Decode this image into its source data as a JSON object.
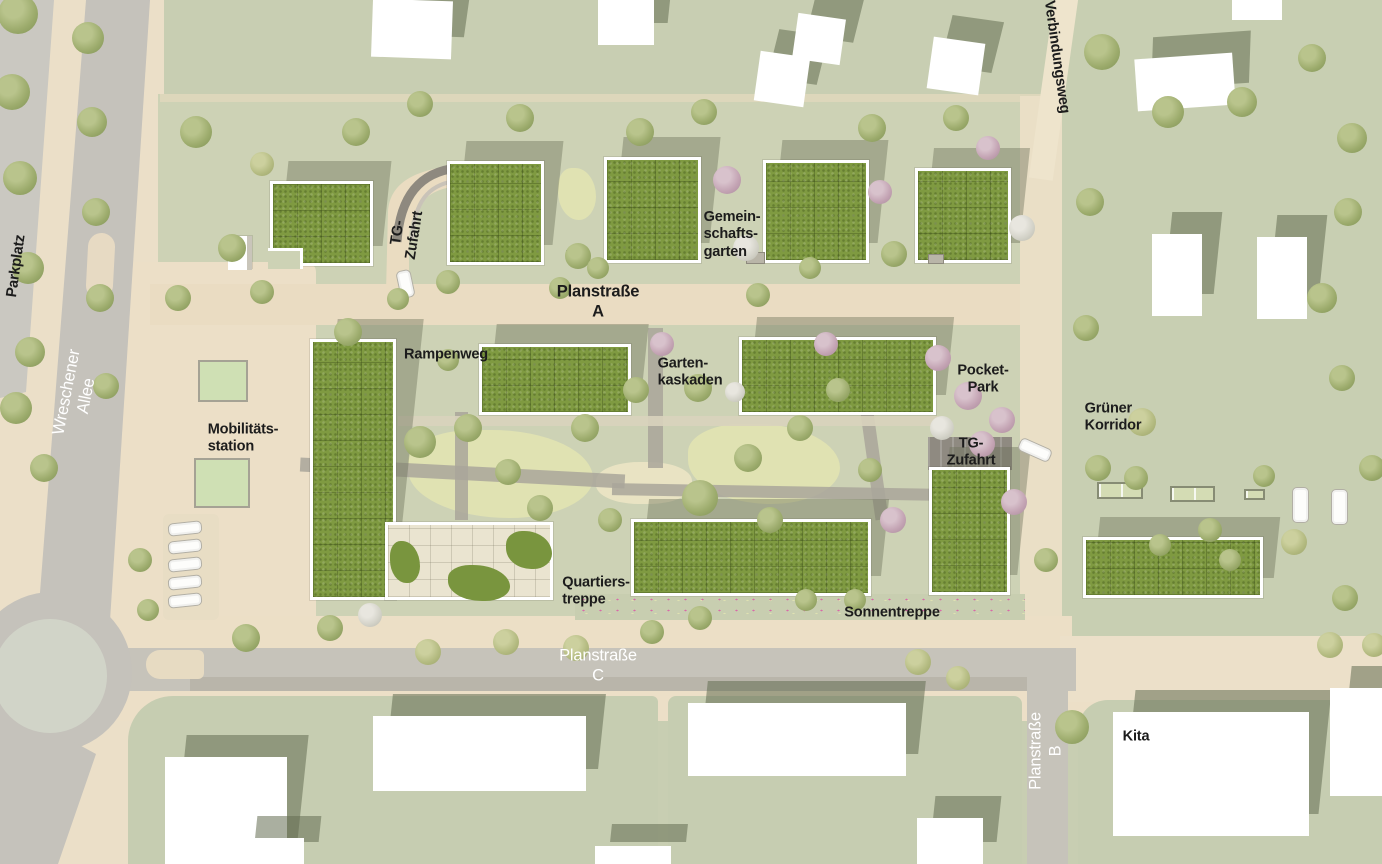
{
  "meta": {
    "title": "Quartier Lageplan (site plan)",
    "width": 1382,
    "height": 864
  },
  "palette": {
    "ground_green": "#cdd2b5",
    "road_gray": "#c6c3ba",
    "road_beige": "#eadcc2",
    "roof_green": "#7f9a41",
    "building_white": "#ffffff",
    "shadow": "#6c7058",
    "label_black": "#1c1c1c",
    "label_white": "#ffffff"
  },
  "labels": [
    {
      "id": "parkplatz",
      "text": "Parkplatz",
      "x": 16,
      "y": 266,
      "rot": -82,
      "color": "#1c1c1c",
      "size": 15,
      "weight": 700,
      "align": "center"
    },
    {
      "id": "wreschener-allee",
      "text": "Wreschener Allee",
      "x": 76,
      "y": 394,
      "rot": -79,
      "color": "#ffffff",
      "size": 17,
      "weight": 400,
      "align": "center"
    },
    {
      "id": "tg-zufahrt-nord",
      "text": "TG-Zufahrt",
      "x": 406,
      "y": 234,
      "rot": -81,
      "color": "#1c1c1c",
      "size": 15,
      "weight": 700,
      "align": "center"
    },
    {
      "id": "verbindungsweg",
      "text": "Verbindungsweg",
      "x": 1057,
      "y": 57,
      "rot": 82,
      "color": "#1c1c1c",
      "size": 15,
      "weight": 700,
      "align": "center"
    },
    {
      "id": "gemeinschaftsgarten",
      "text": "Gemein-\nschafts-\ngarten",
      "x": 732,
      "y": 234,
      "rot": 0,
      "color": "#1c1c1c",
      "size": 15,
      "weight": 700,
      "align": "left"
    },
    {
      "id": "planstrasse-a",
      "text": "Planstraße A",
      "x": 598,
      "y": 301,
      "rot": 0,
      "color": "#1c1c1c",
      "size": 17,
      "weight": 700,
      "align": "center"
    },
    {
      "id": "rampenweg",
      "text": "Rampenweg",
      "x": 446,
      "y": 354,
      "rot": 0,
      "color": "#1c1c1c",
      "size": 15,
      "weight": 700,
      "align": "center"
    },
    {
      "id": "gartenkaskaden",
      "text": "Garten-\nkaskaden",
      "x": 690,
      "y": 372,
      "rot": 0,
      "color": "#1c1c1c",
      "size": 15,
      "weight": 700,
      "align": "left"
    },
    {
      "id": "pocket-park",
      "text": "Pocket-Park",
      "x": 983,
      "y": 379,
      "rot": 0,
      "color": "#1c1c1c",
      "size": 15,
      "weight": 700,
      "align": "center"
    },
    {
      "id": "gruener-korridor",
      "text": "Grüner\nKorridor",
      "x": 1113,
      "y": 417,
      "rot": 0,
      "color": "#1c1c1c",
      "size": 15,
      "weight": 700,
      "align": "left"
    },
    {
      "id": "mobilitaetsstation",
      "text": "Mobilitäts-\nstation",
      "x": 243,
      "y": 438,
      "rot": 0,
      "color": "#1c1c1c",
      "size": 15,
      "weight": 700,
      "align": "left"
    },
    {
      "id": "tg-zufahrt-mitte",
      "text": "TG-Zufahrt",
      "x": 971,
      "y": 452,
      "rot": 0,
      "color": "#1c1c1c",
      "size": 15,
      "weight": 700,
      "align": "center"
    },
    {
      "id": "quartierstreppe",
      "text": "Quartiers-\ntreppe",
      "x": 596,
      "y": 591,
      "rot": 0,
      "color": "#1c1c1c",
      "size": 15,
      "weight": 700,
      "align": "left"
    },
    {
      "id": "sonnentreppe",
      "text": "Sonnentreppe",
      "x": 892,
      "y": 612,
      "rot": 0,
      "color": "#1c1c1c",
      "size": 15,
      "weight": 700,
      "align": "center"
    },
    {
      "id": "planstrasse-c",
      "text": "Planstraße C",
      "x": 598,
      "y": 665,
      "rot": 0,
      "color": "#ffffff",
      "size": 17,
      "weight": 400,
      "align": "center"
    },
    {
      "id": "planstrasse-b",
      "text": "Planstraße B",
      "x": 1045,
      "y": 751,
      "rot": -90,
      "color": "#ffffff",
      "size": 17,
      "weight": 400,
      "align": "center"
    },
    {
      "id": "kita",
      "text": "Kita",
      "x": 1136,
      "y": 736,
      "rot": 0,
      "color": "#1c1c1c",
      "size": 15,
      "weight": 700,
      "align": "center"
    }
  ],
  "site_buildings": [
    {
      "id": "hof-nord-1",
      "x": 270,
      "y": 181,
      "w": 103,
      "h": 85
    },
    {
      "id": "hof-nord-2",
      "x": 447,
      "y": 161,
      "w": 97,
      "h": 104
    },
    {
      "id": "hof-nord-3",
      "x": 604,
      "y": 157,
      "w": 97,
      "h": 106
    },
    {
      "id": "hof-nord-4",
      "x": 763,
      "y": 160,
      "w": 106,
      "h": 103
    },
    {
      "id": "hof-nord-5",
      "x": 915,
      "y": 168,
      "w": 96,
      "h": 95
    },
    {
      "id": "block-west",
      "x": 310,
      "y": 339,
      "w": 86,
      "h": 261
    },
    {
      "id": "block-nord-mitte",
      "x": 479,
      "y": 344,
      "w": 152,
      "h": 71
    },
    {
      "id": "block-nord-ost",
      "x": 739,
      "y": 337,
      "w": 197,
      "h": 78
    },
    {
      "id": "block-ost",
      "x": 929,
      "y": 467,
      "w": 81,
      "h": 128
    },
    {
      "id": "block-sued",
      "x": 631,
      "y": 519,
      "w": 240,
      "h": 77
    },
    {
      "id": "zeile-ost",
      "x": 1083,
      "y": 537,
      "w": 180,
      "h": 61
    }
  ],
  "plan_building": {
    "id": "quartierstreppe-haus",
    "x": 385,
    "y": 522,
    "w": 168,
    "h": 78,
    "green_patches": [
      [
        2,
        16,
        30,
        42
      ],
      [
        118,
        6,
        46,
        38
      ],
      [
        60,
        40,
        62,
        36
      ]
    ]
  },
  "roof_notch": {
    "x": 268,
    "y": 248,
    "w": 35,
    "h": 21
  },
  "context_buildings": [
    {
      "x": 372,
      "y": 0,
      "w": 80,
      "h": 58,
      "rot": 2
    },
    {
      "x": 598,
      "y": 0,
      "w": 56,
      "h": 45,
      "rot": 0
    },
    {
      "x": 757,
      "y": 54,
      "w": 50,
      "h": 50,
      "rot": 8
    },
    {
      "x": 795,
      "y": 16,
      "w": 48,
      "h": 46,
      "rot": 8
    },
    {
      "x": 930,
      "y": 40,
      "w": 52,
      "h": 52,
      "rot": 8
    },
    {
      "x": 1136,
      "y": 56,
      "w": 98,
      "h": 52,
      "rot": -4
    },
    {
      "x": 1232,
      "y": 0,
      "w": 50,
      "h": 20,
      "rot": 0
    },
    {
      "x": 1152,
      "y": 234,
      "w": 50,
      "h": 82,
      "rot": 0
    },
    {
      "x": 1257,
      "y": 237,
      "w": 50,
      "h": 82,
      "rot": 0
    },
    {
      "x": 165,
      "y": 757,
      "w": 122,
      "h": 107,
      "rot": 0
    },
    {
      "x": 373,
      "y": 716,
      "w": 213,
      "h": 75,
      "rot": 0
    },
    {
      "x": 688,
      "y": 703,
      "w": 218,
      "h": 73,
      "rot": 0
    },
    {
      "x": 1113,
      "y": 712,
      "w": 196,
      "h": 124,
      "rot": 0
    },
    {
      "x": 1330,
      "y": 688,
      "w": 52,
      "h": 108,
      "rot": 0
    },
    {
      "x": 917,
      "y": 818,
      "w": 66,
      "h": 46,
      "rot": 0
    },
    {
      "x": 240,
      "y": 838,
      "w": 64,
      "h": 26,
      "rot": 0
    },
    {
      "x": 595,
      "y": 846,
      "w": 76,
      "h": 18,
      "rot": 0
    }
  ],
  "green_blocks_south": [
    {
      "x": 128,
      "y": 696,
      "w": 530,
      "h": 168,
      "r": "45px 6px 0 0"
    },
    {
      "x": 668,
      "y": 696,
      "w": 354,
      "h": 168,
      "r": "8px 8px 0 0"
    },
    {
      "x": 1078,
      "y": 700,
      "w": 304,
      "h": 164,
      "r": "30px 0 0 0"
    }
  ],
  "ground_patches": [
    {
      "kind": "pale",
      "x": 558,
      "y": 168,
      "w": 38,
      "h": 52
    },
    {
      "kind": "pale",
      "x": 408,
      "y": 430,
      "w": 185,
      "h": 88
    },
    {
      "kind": "pale",
      "x": 688,
      "y": 424,
      "w": 152,
      "h": 80
    },
    {
      "kind": "sand",
      "x": 596,
      "y": 462,
      "w": 96,
      "h": 42
    },
    {
      "kind": "ramp",
      "x": 198,
      "y": 360,
      "w": 50,
      "h": 42
    },
    {
      "kind": "ramp",
      "x": 194,
      "y": 458,
      "w": 56,
      "h": 50
    }
  ],
  "paths": [
    {
      "x": 300,
      "y": 466,
      "w": 325,
      "h": 14,
      "rot": 3
    },
    {
      "x": 612,
      "y": 486,
      "w": 330,
      "h": 12,
      "rot": 1
    },
    {
      "x": 648,
      "y": 328,
      "w": 15,
      "h": 140,
      "rot": 0
    },
    {
      "x": 455,
      "y": 412,
      "w": 13,
      "h": 108,
      "rot": 0
    },
    {
      "x": 868,
      "y": 412,
      "w": 13,
      "h": 108,
      "rot": -8
    },
    {
      "x": 398,
      "y": 416,
      "w": 540,
      "h": 10,
      "rot": 0,
      "walk": true
    }
  ],
  "garages": [
    {
      "x": 1097,
      "y": 482,
      "w": 46,
      "h": 17
    },
    {
      "x": 1170,
      "y": 486,
      "w": 45,
      "h": 16
    },
    {
      "x": 1244,
      "y": 489,
      "w": 21,
      "h": 11
    }
  ],
  "sheds": [
    {
      "x": 746,
      "y": 252,
      "w": 19,
      "h": 12
    },
    {
      "x": 566,
      "y": 250,
      "w": 18,
      "h": 11
    },
    {
      "x": 928,
      "y": 254,
      "w": 16,
      "h": 10
    }
  ],
  "white_shed": {
    "x": 228,
    "y": 236,
    "w": 24,
    "h": 34
  },
  "cars": [
    {
      "x": 168,
      "y": 522,
      "w": 34,
      "h": 13,
      "rot": -6
    },
    {
      "x": 168,
      "y": 540,
      "w": 34,
      "h": 13,
      "rot": -6
    },
    {
      "x": 168,
      "y": 558,
      "w": 34,
      "h": 13,
      "rot": -6
    },
    {
      "x": 168,
      "y": 576,
      "w": 34,
      "h": 13,
      "rot": -6
    },
    {
      "x": 168,
      "y": 594,
      "w": 34,
      "h": 13,
      "rot": -6
    },
    {
      "x": 398,
      "y": 270,
      "w": 15,
      "h": 28,
      "rot": -12
    },
    {
      "x": 1018,
      "y": 443,
      "w": 34,
      "h": 14,
      "rot": 24
    },
    {
      "x": 1292,
      "y": 487,
      "w": 17,
      "h": 36,
      "rot": 0
    },
    {
      "x": 1331,
      "y": 489,
      "w": 17,
      "h": 36,
      "rot": 0
    }
  ],
  "trees": [
    [
      18,
      14,
      20
    ],
    [
      88,
      38,
      16
    ],
    [
      12,
      92,
      18
    ],
    [
      92,
      122,
      15
    ],
    [
      20,
      178,
      17
    ],
    [
      96,
      212,
      14
    ],
    [
      28,
      268,
      16
    ],
    [
      100,
      298,
      14
    ],
    [
      30,
      352,
      15
    ],
    [
      16,
      408,
      16
    ],
    [
      106,
      386,
      13
    ],
    [
      44,
      468,
      14
    ],
    [
      196,
      132,
      16
    ],
    [
      232,
      248,
      14
    ],
    [
      262,
      164,
      12,
      "o"
    ],
    [
      356,
      132,
      14
    ],
    [
      420,
      104,
      13
    ],
    [
      448,
      282,
      12
    ],
    [
      520,
      118,
      14
    ],
    [
      578,
      256,
      13
    ],
    [
      640,
      132,
      14
    ],
    [
      704,
      112,
      13
    ],
    [
      727,
      180,
      14,
      "p"
    ],
    [
      746,
      248,
      13,
      "w"
    ],
    [
      872,
      128,
      14
    ],
    [
      894,
      254,
      13
    ],
    [
      956,
      118,
      13
    ],
    [
      988,
      148,
      12,
      "p"
    ],
    [
      1022,
      228,
      13,
      "w"
    ],
    [
      880,
      192,
      12,
      "p"
    ],
    [
      598,
      268,
      11
    ],
    [
      810,
      268,
      11
    ],
    [
      178,
      298,
      13
    ],
    [
      262,
      292,
      12
    ],
    [
      398,
      299,
      11
    ],
    [
      560,
      288,
      11
    ],
    [
      758,
      295,
      12
    ],
    [
      348,
      332,
      14
    ],
    [
      420,
      442,
      16
    ],
    [
      468,
      428,
      14
    ],
    [
      508,
      472,
      13
    ],
    [
      585,
      428,
      14
    ],
    [
      636,
      390,
      13
    ],
    [
      698,
      388,
      14
    ],
    [
      540,
      508,
      13
    ],
    [
      700,
      498,
      18
    ],
    [
      748,
      458,
      14
    ],
    [
      800,
      428,
      13
    ],
    [
      838,
      390,
      12
    ],
    [
      662,
      344,
      12,
      "p"
    ],
    [
      826,
      344,
      12,
      "p"
    ],
    [
      770,
      520,
      13
    ],
    [
      610,
      520,
      12
    ],
    [
      870,
      470,
      12
    ],
    [
      448,
      360,
      11
    ],
    [
      735,
      392,
      10,
      "w"
    ],
    [
      938,
      358,
      13,
      "p"
    ],
    [
      968,
      396,
      14,
      "p"
    ],
    [
      1002,
      420,
      13,
      "p"
    ],
    [
      942,
      428,
      12,
      "w"
    ],
    [
      982,
      444,
      13,
      "p"
    ],
    [
      1014,
      502,
      13,
      "p"
    ],
    [
      893,
      520,
      13,
      "p"
    ],
    [
      1102,
      52,
      18
    ],
    [
      1168,
      112,
      16
    ],
    [
      1242,
      102,
      15
    ],
    [
      1312,
      58,
      14
    ],
    [
      1352,
      138,
      15
    ],
    [
      1090,
      202,
      14
    ],
    [
      1348,
      212,
      14
    ],
    [
      1322,
      298,
      15
    ],
    [
      1086,
      328,
      13
    ],
    [
      1142,
      422,
      14,
      "o"
    ],
    [
      1098,
      468,
      13
    ],
    [
      1342,
      378,
      13
    ],
    [
      1372,
      468,
      13
    ],
    [
      1294,
      542,
      13,
      "o"
    ],
    [
      1345,
      598,
      13
    ],
    [
      1136,
      478,
      12
    ],
    [
      1210,
      530,
      12
    ],
    [
      1264,
      476,
      11
    ],
    [
      1330,
      645,
      13,
      "o"
    ],
    [
      1374,
      645,
      12,
      "o"
    ],
    [
      1230,
      560,
      11
    ],
    [
      1160,
      545,
      11
    ],
    [
      246,
      638,
      14
    ],
    [
      330,
      628,
      13
    ],
    [
      428,
      652,
      13,
      "o"
    ],
    [
      506,
      642,
      13,
      "o"
    ],
    [
      576,
      648,
      13,
      "o"
    ],
    [
      652,
      632,
      12
    ],
    [
      700,
      618,
      12
    ],
    [
      918,
      662,
      13,
      "o"
    ],
    [
      958,
      678,
      12,
      "o"
    ],
    [
      855,
      600,
      11
    ],
    [
      806,
      600,
      11
    ],
    [
      1072,
      727,
      17
    ],
    [
      1046,
      560,
      12
    ],
    [
      370,
      615,
      12,
      "w"
    ],
    [
      140,
      560,
      12
    ],
    [
      148,
      610,
      11
    ]
  ]
}
